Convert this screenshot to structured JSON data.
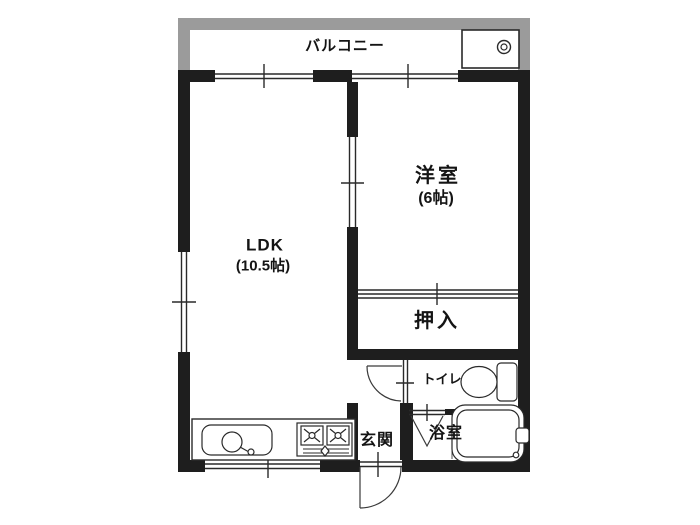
{
  "floorplan": {
    "rooms": {
      "balcony": {
        "label": "バルコニー"
      },
      "western_room": {
        "label": "洋室",
        "size": "(6帖)"
      },
      "ldk": {
        "label": "LDK",
        "size": "(10.5帖)"
      },
      "closet": {
        "label": "押入"
      },
      "toilet": {
        "label": "トイレ"
      },
      "entrance": {
        "label": "玄関"
      },
      "bathroom": {
        "label": "浴室"
      }
    },
    "colors": {
      "wall": "#1e1e1e",
      "balcony_rail": "#9b9b9b",
      "line": "#2a2a2a",
      "background": "#ffffff"
    },
    "fixtures": {
      "washing_machine_pan": "washing-machine-pan-icon",
      "toilet": "toilet-icon",
      "bathtub": "bathtub-icon",
      "kitchen_sink": "kitchen-sink-icon",
      "stove": "stove-icon",
      "entry_door": "door-swing-icon",
      "hall_door": "door-swing-icon",
      "bath_folding_door": "folding-door-icon"
    }
  }
}
